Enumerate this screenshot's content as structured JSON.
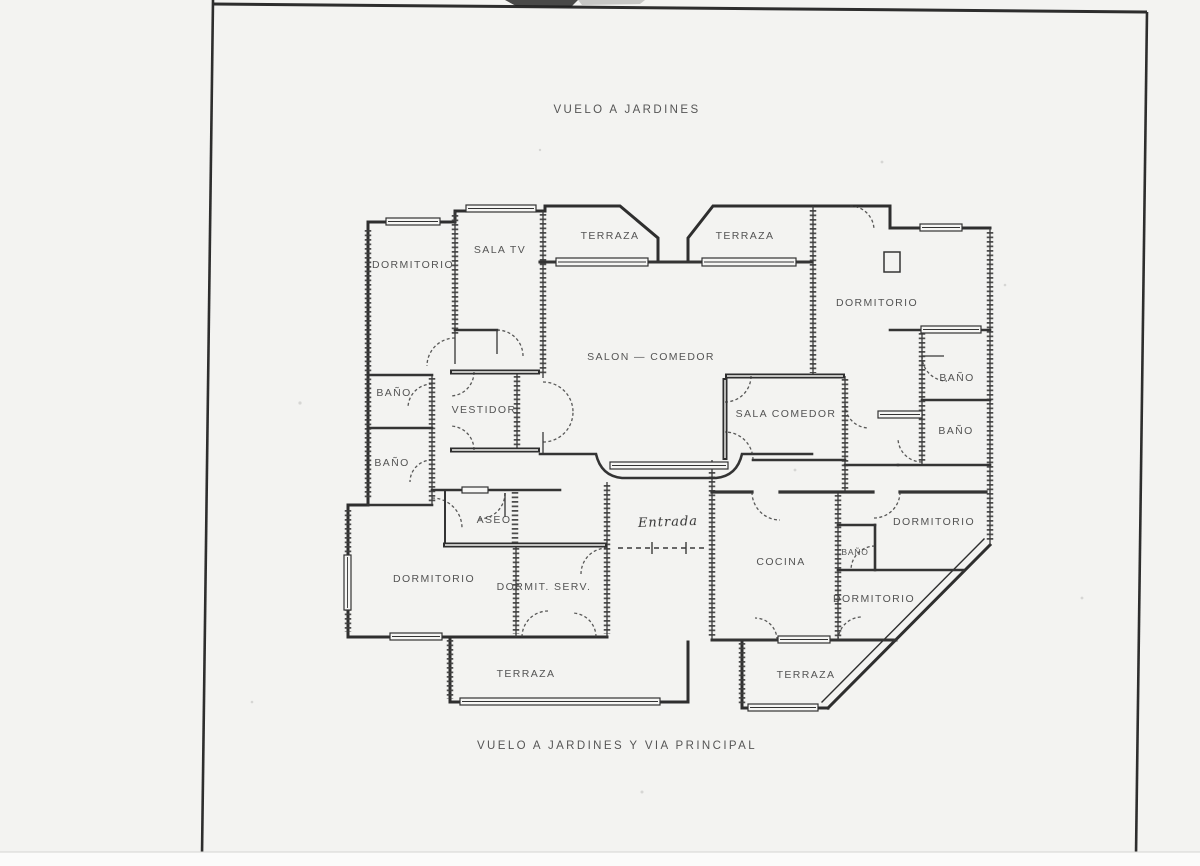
{
  "page": {
    "title_top": "VUELO A JARDINES",
    "title_bottom": "VUELO A JARDINES Y VIA PRINCIPAL"
  },
  "plan": {
    "rooms": [
      {
        "id": "dormitorio-top-left",
        "label": "DORMITORIO"
      },
      {
        "id": "sala-tv",
        "label": "SALA TV"
      },
      {
        "id": "terraza-top-left",
        "label": "TERRAZA"
      },
      {
        "id": "terraza-top-right",
        "label": "TERRAZA"
      },
      {
        "id": "dormitorio-top-right",
        "label": "DORMITORIO"
      },
      {
        "id": "salon-comedor",
        "label": "SALON — COMEDOR"
      },
      {
        "id": "bano-left-1",
        "label": "BAÑO"
      },
      {
        "id": "bano-left-2",
        "label": "BAÑO"
      },
      {
        "id": "vestidor",
        "label": "VESTIDOR"
      },
      {
        "id": "sala-comedor",
        "label": "SALA COMEDOR"
      },
      {
        "id": "bano-right-1",
        "label": "BAÑO"
      },
      {
        "id": "bano-right-2",
        "label": "BAÑO"
      },
      {
        "id": "aseo",
        "label": "ASEO"
      },
      {
        "id": "entrada",
        "label": "Entrada"
      },
      {
        "id": "dormitorio-bottom-left",
        "label": "DORMITORIO"
      },
      {
        "id": "dormit-serv",
        "label": "DORMIT. SERV."
      },
      {
        "id": "cocina",
        "label": "COCINA"
      },
      {
        "id": "bano-servicio",
        "label": "BAÑO"
      },
      {
        "id": "dormitorio-right-upper",
        "label": "DORMITORIO"
      },
      {
        "id": "dormitorio-right-lower",
        "label": "DORMITORIO"
      },
      {
        "id": "terraza-bottom-left",
        "label": "TERRAZA"
      },
      {
        "id": "terraza-bottom-right",
        "label": "TERRAZA"
      }
    ]
  },
  "colors": {
    "ink": "#3a3a3a",
    "paper": "#f3f3f1",
    "frame": "#2d2d2d"
  }
}
